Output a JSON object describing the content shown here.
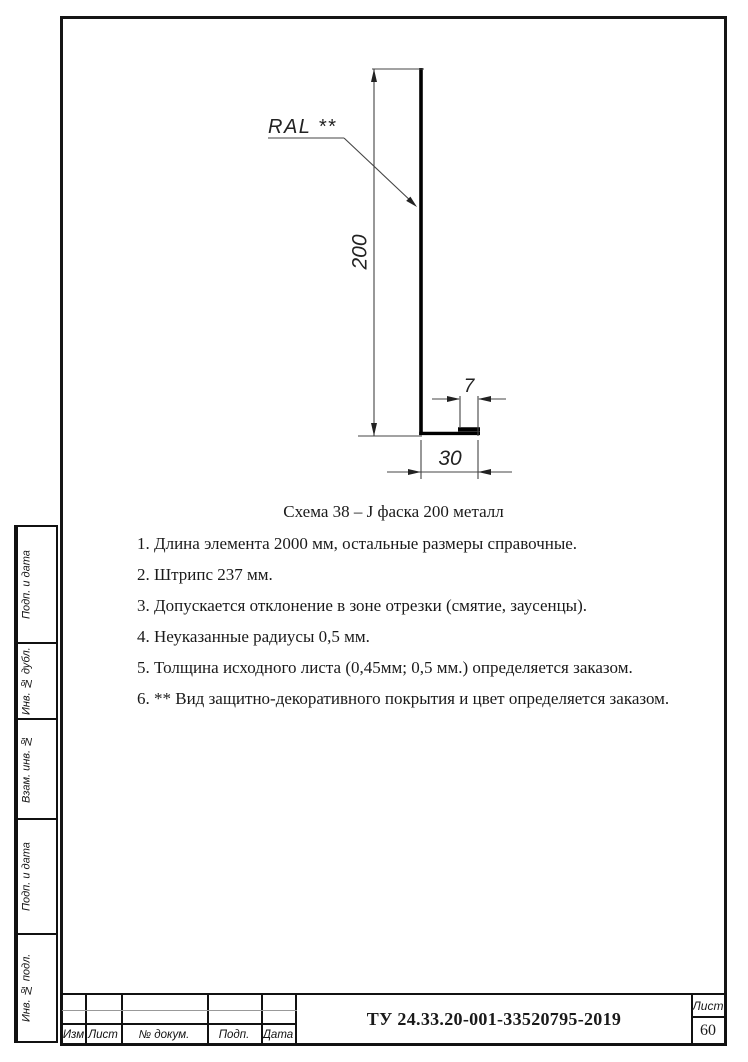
{
  "colors": {
    "ink": "#1a1a1a",
    "thin_line": "#444444",
    "thick_line": "#000000",
    "gray_line": "#999999"
  },
  "drawing": {
    "ral_label": "RAL **",
    "dim_height": "200",
    "dim_lip": "7",
    "dim_flange": "30"
  },
  "caption": "Схема 38 – J фаска 200 металл",
  "notes": [
    "1. Длина элемента 2000 мм, остальные размеры справочные.",
    "2. Штрипс 237 мм.",
    "3. Допускается отклонение в зоне отрезки (смятие, заусенцы).",
    "4. Неуказанные радиусы 0,5 мм.",
    "5. Толщина исходного листа (0,45мм; 0,5 мм.) определяется заказом.",
    "6. ** Вид защитно-декоративного покрытия и цвет определяется заказом."
  ],
  "sidebar": {
    "cells": [
      {
        "label": "Подп. и дата"
      },
      {
        "label": "Инв. № дубл."
      },
      {
        "label": "Взам. инв. №"
      },
      {
        "label": "Подп. и дата"
      },
      {
        "label": "Инв. № подл."
      }
    ]
  },
  "title_block": {
    "doc_number": "ТУ 24.33.20-001-33520795-2019",
    "columns": [
      "Изм",
      "Лист",
      "№ докум.",
      "Подп.",
      "Дата"
    ],
    "sheet_label": "Лист",
    "sheet_number": "60"
  }
}
